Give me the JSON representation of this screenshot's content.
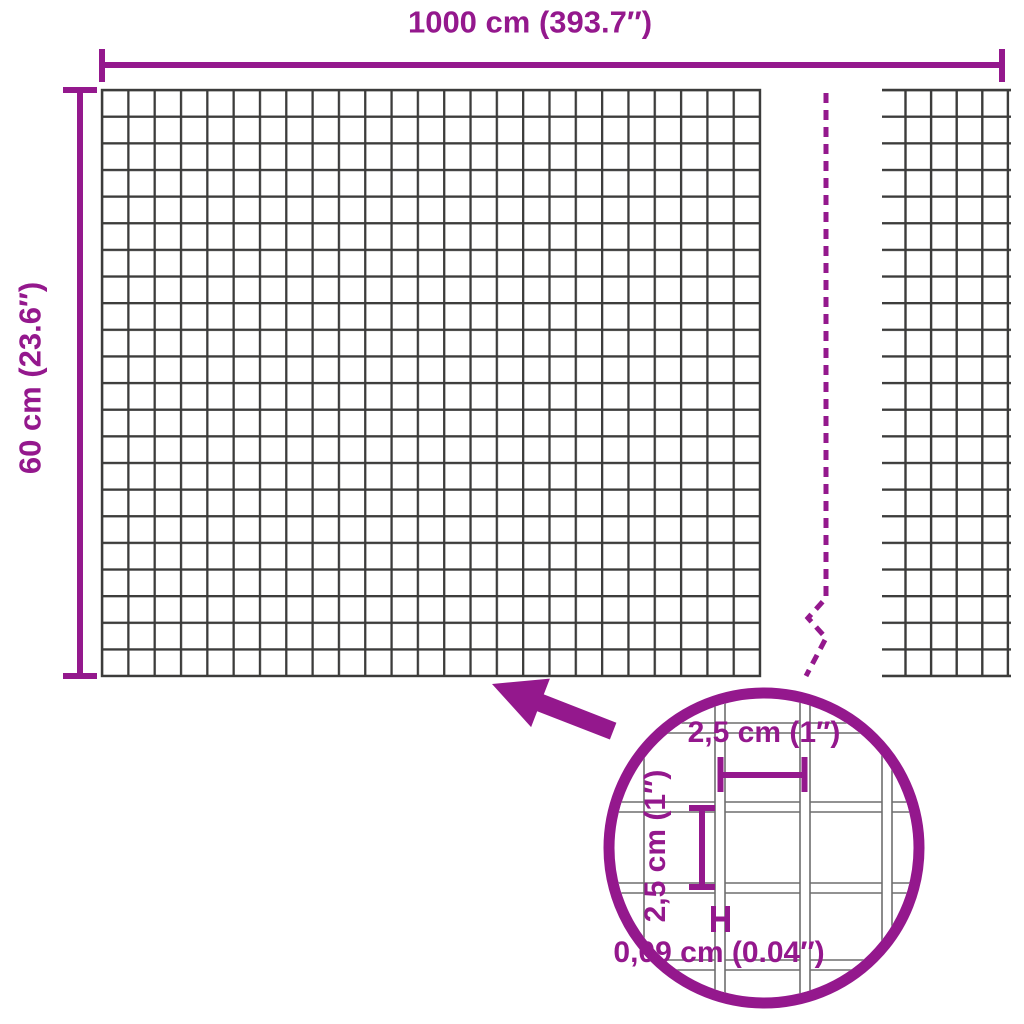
{
  "title": "Wire mesh dimensions diagram",
  "colors": {
    "accent": "#94188D",
    "mesh_line": "#3C3C3B",
    "wire_line": "#6E6E6E"
  },
  "labels": {
    "total_width": "1000 cm (393.7″)",
    "total_height": "60 cm (23.6″)"
  },
  "detail": {
    "mesh_opening_width": "2,5 cm (1″)",
    "mesh_opening_height": "2,5 cm (1″)",
    "wire_thickness": "0,09 cm (0.04″)"
  },
  "icons": {
    "arrow": "arrow-icon",
    "magnifier": "zoom-detail-circle"
  }
}
